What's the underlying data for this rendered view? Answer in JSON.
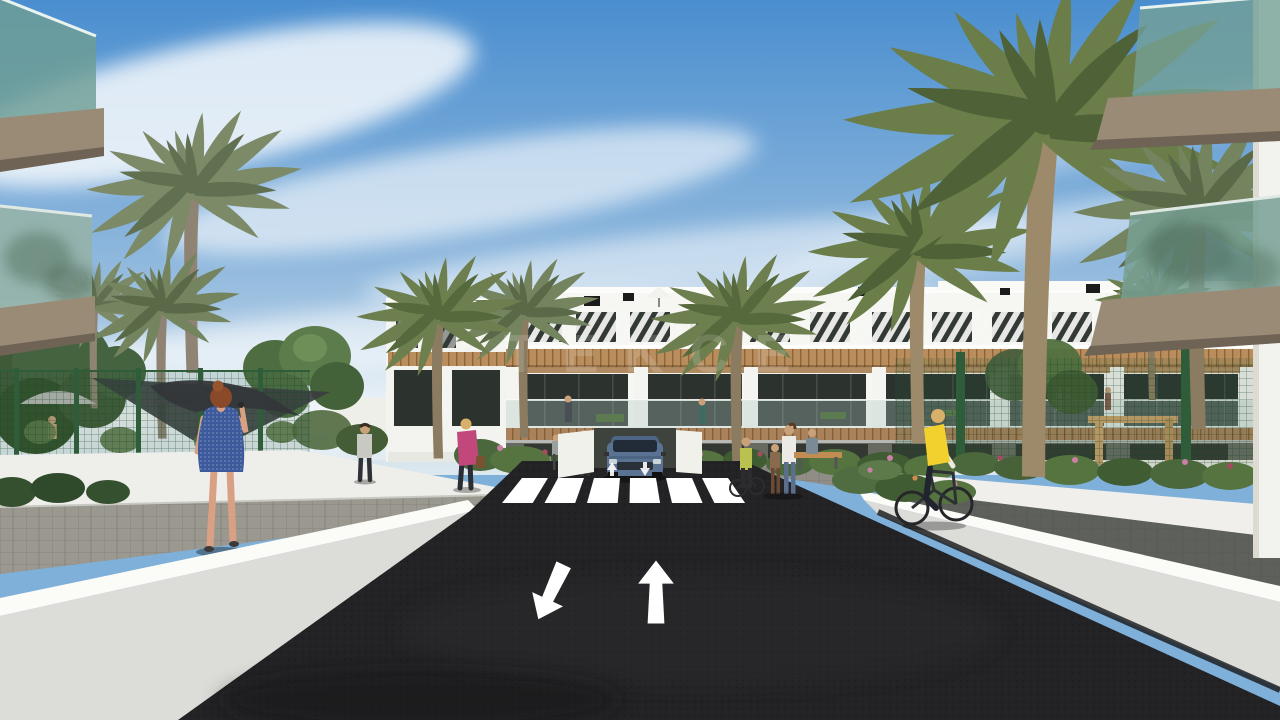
{
  "image": {
    "type": "3d-architectural-render",
    "subject": "Street-level render of a modern white apartment complex lined with palm trees; asphalt road with lane arrows and a zebra crosswalk leads to the buildings",
    "width_px": 1280,
    "height_px": 720
  },
  "watermark": {
    "text": "TEKCE"
  },
  "palette": {
    "sky_top": "#4a8ecf",
    "sky_mid": "#8fb8dd",
    "sky_horizon": "#dde8ee",
    "cloud": "#ffffff",
    "building_white": "#f6f6f3",
    "window_dark": "#333a36",
    "wood": "#b98d5c",
    "glass_balcony": "#74a096",
    "palm_frond": "#6d7f4e",
    "palm_trunk": "#8b7b60",
    "tree_green": "#4b6b3f",
    "fence_green": "#2f5d3a",
    "asphalt": "#232326",
    "road_marking": "#ffffff",
    "wall_face": "#dcdcd8",
    "paver_gray": "#97958f",
    "car_blue": "#5a7393",
    "dress_blue": "#3d5a9c",
    "vest_yellow": "#f2d12e",
    "jacket_pink": "#c2487c",
    "watermark_white": "#ffffff"
  },
  "scene_objects": [
    "blue sky with wispy cirrus clouds",
    "white three-storey apartment block with wood pergola bands and striped louver railings",
    "foreground glass-railing balconies in both top corners",
    "tall palm trees and round leafy trees",
    "green mesh fence around pool terrace with parasols and shade sail",
    "dark asphalt road with one up arrow and one down-left arrow",
    "zebra crosswalk",
    "blue SUV at the driveway",
    "woman in blue dotted dress on the phone (left sidewalk)",
    "cyclist in yellow vest (right path)",
    "woman in pink jacket, man, mother with child, seated person",
    "white perimeter walls and paved sidewalks",
    "landscaped bushes with pink and red flowers"
  ]
}
